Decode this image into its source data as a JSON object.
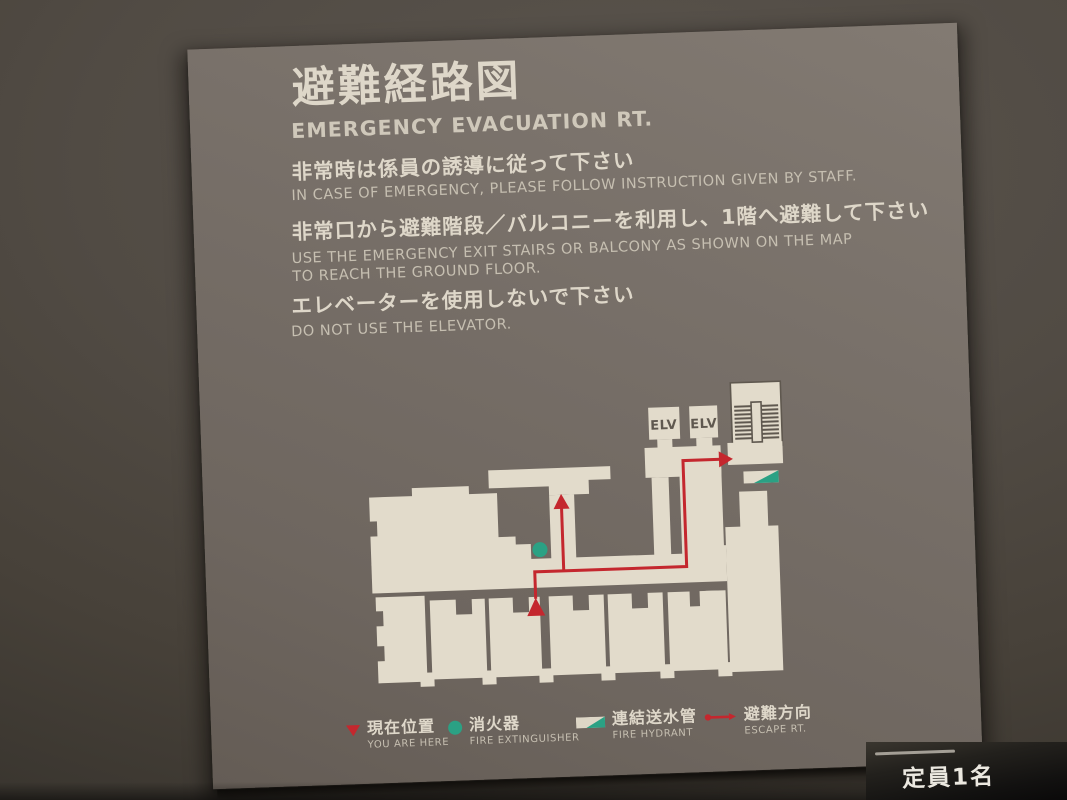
{
  "sign": {
    "title_jp": "避難経路図",
    "title_en": "EMERGENCY EVACUATION RT.",
    "instructions": [
      {
        "jp": "非常時は係員の誘導に従って下さい",
        "en1": "IN CASE OF EMERGENCY, PLEASE FOLLOW INSTRUCTION GIVEN BY STAFF."
      },
      {
        "jp": "非常口から避難階段／バルコニーを利用し、1階へ避難して下さい",
        "en1": "USE THE EMERGENCY EXIT STAIRS OR BALCONY AS SHOWN ON THE MAP",
        "en2": "TO REACH THE GROUND FLOOR."
      },
      {
        "jp": "エレベーターを使用しないで下さい",
        "en1": "DO NOT USE THE ELEVATOR."
      }
    ],
    "map": {
      "elevator_labels": [
        "ELV",
        "ELV"
      ]
    },
    "legend": [
      {
        "jp": "現在位置",
        "en": "YOU ARE HERE",
        "symbol": "current-position-triangle"
      },
      {
        "jp": "消火器",
        "en": "FIRE EXTINGUISHER",
        "symbol": "fire-extinguisher-dot"
      },
      {
        "jp": "連結送水管",
        "en": "FIRE HYDRANT",
        "symbol": "fire-hydrant-wedge"
      },
      {
        "jp": "避難方向",
        "en": "ESCAPE RT.",
        "symbol": "escape-route-arrow"
      }
    ],
    "colors": {
      "route-red": "#c4272e",
      "marker-green": "#2ba184",
      "map-cream": "#e2dbcb",
      "map-dark": "#5f584f",
      "panel-text": "#ded7c9",
      "panel-subtext": "#c6bfb1"
    }
  },
  "capacity_plate": {
    "text": "定員1名"
  }
}
